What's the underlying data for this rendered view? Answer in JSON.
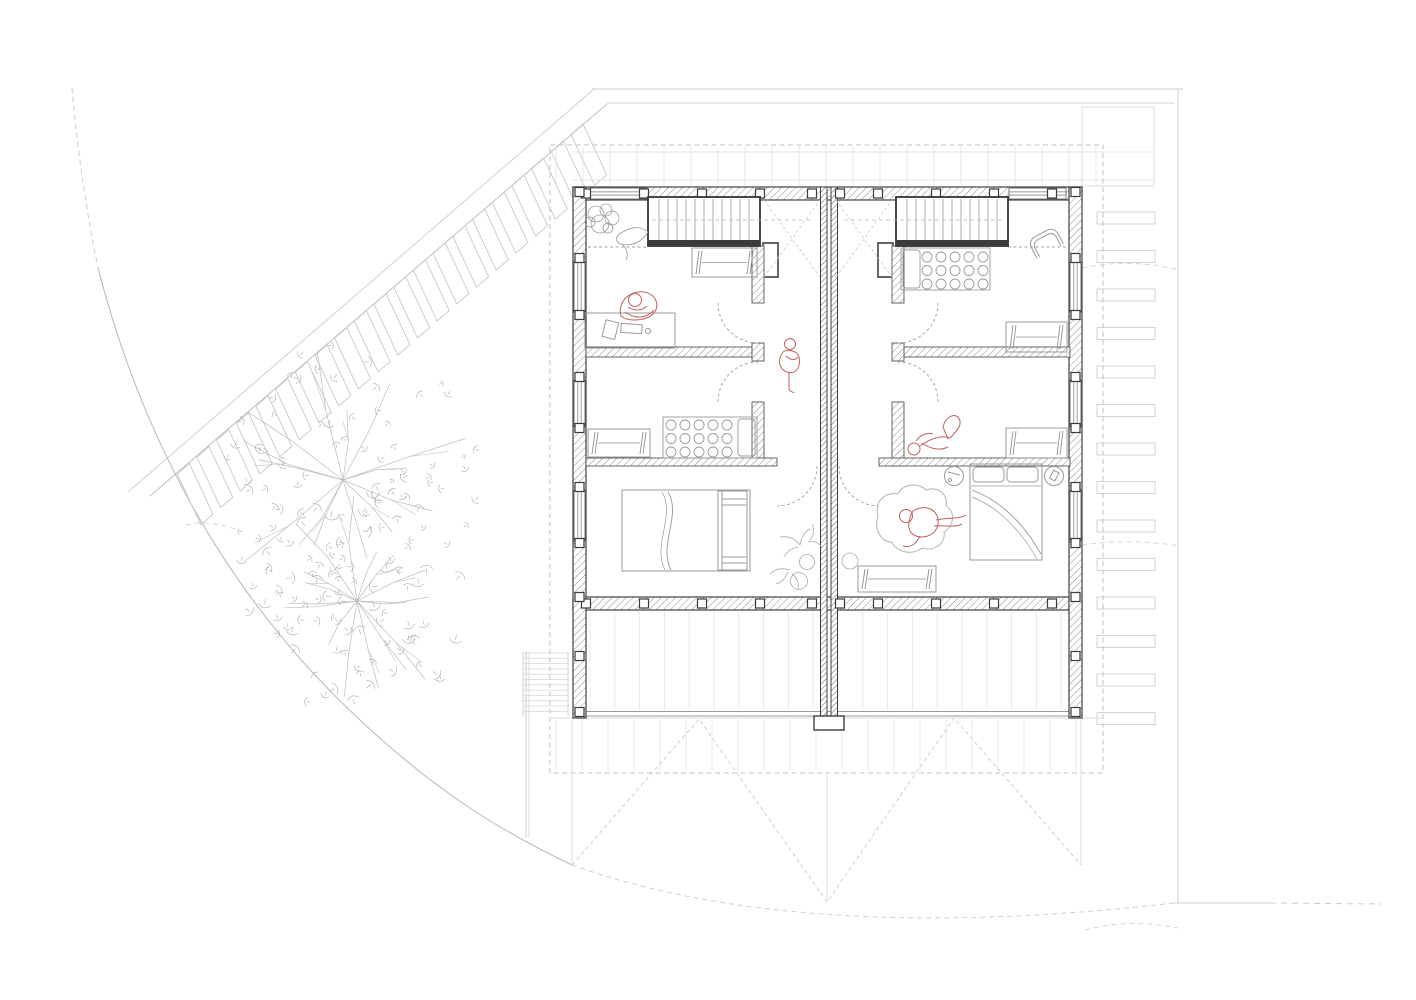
{
  "document": {
    "type": "architectural-floor-plan",
    "view": "upper-floor plan of mirrored duplex (two dwelling units) with site context",
    "visible_text": "none",
    "units": 2
  },
  "colors": {
    "wall": "#3f3f3f",
    "wall_mid": "#8f8f8f",
    "furniture": "#9a9a9a",
    "site": "#c6c6c6",
    "faint": "#e4e4e4",
    "figure_red": "#c0625c",
    "dashed": "#b9b9b9",
    "light": "#d8d8d8"
  },
  "figures": [
    {
      "id": "person-at-desk",
      "pose": "seated at desk",
      "unit": "left",
      "room": "top-left study"
    },
    {
      "id": "person-standing-hall",
      "pose": "standing on stair landing",
      "unit": "left"
    },
    {
      "id": "person-on-bed",
      "pose": "reclining on bed, knees up",
      "unit": "right",
      "room": "middle bedroom"
    },
    {
      "id": "person-in-beanbag",
      "pose": "lounging in beanbag",
      "unit": "right",
      "room": "master bedroom"
    }
  ],
  "drawing": {
    "site": {
      "parking": {
        "start": [
          583,
          124
        ],
        "roadDir": [
          -0.757,
          0.653
        ],
        "step": 26,
        "count": 21,
        "stallAlong": 16,
        "stallDeep": 56,
        "deepDir": [
          0.423,
          0.906
        ]
      },
      "steps": {
        "x": 1097,
        "w": 58,
        "h": 12,
        "y0": 212,
        "dy": 38.5,
        "count": 14
      },
      "trees": [
        {
          "cx": 343,
          "cy": 480,
          "branches": 14,
          "rMin": 60,
          "rMax": 135,
          "leaves": 72,
          "ringMin": 30,
          "ringMax": 140,
          "leafSize": 4,
          "seed": 7
        },
        {
          "cx": 357,
          "cy": 601,
          "branches": 16,
          "rMin": 50,
          "rMax": 112,
          "leaves": 84,
          "ringMin": 18,
          "ringMax": 116,
          "leafSize": 5,
          "seed": 13
        }
      ],
      "contours": [
        "M1082,268 Q1130,258 1180,270",
        "M1082,545 Q1130,538 1180,546",
        "M1085,930 Q1130,918 1178,928",
        "M186,525 Q210,519 240,531"
      ],
      "extStair": {
        "x0": 523,
        "x1": 568,
        "y0": 653,
        "dy": 5.3,
        "n": 12
      }
    },
    "building": {
      "rafterTop": {
        "x0": 556,
        "x1": 1098,
        "y0": 146,
        "y1": 186,
        "dx": 27
      },
      "rafterBottom": {
        "x0": 556,
        "x1": 1098,
        "y0": 719,
        "y1": 771,
        "dx": 26
      },
      "decking": {
        "x0": 590,
        "x1": 1066,
        "y0": 612,
        "y1": 710,
        "dx": 24.8
      },
      "posts": {
        "topXs": [
          586,
          644,
          702,
          760,
          812,
          840,
          878,
          936,
          994,
          1052
        ],
        "southXs": [
          586,
          644,
          702,
          760,
          812,
          840,
          878,
          936,
          994,
          1052
        ],
        "westYs": [
          192,
          258,
          315,
          377,
          428,
          487,
          543,
          597,
          656,
          712
        ],
        "eastYs": [
          192,
          258,
          315,
          377,
          428,
          487,
          543,
          597,
          656,
          712
        ]
      },
      "windows": {
        "north": [
          {
            "x": 590,
            "w": 57
          },
          {
            "x": 1009,
            "w": 57
          }
        ],
        "west": [
          {
            "y": 262,
            "h": 50
          },
          {
            "y": 380,
            "h": 47
          },
          {
            "y": 490,
            "h": 51
          }
        ],
        "east": [
          {
            "y": 262,
            "h": 50
          },
          {
            "y": 380,
            "h": 47
          },
          {
            "y": 490,
            "h": 51
          }
        ]
      },
      "stairs": [
        {
          "x": 648,
          "y": 197,
          "w": 112,
          "h": 49,
          "treadX0": 659,
          "treadDx": 9,
          "n": 11,
          "walk": [
            652,
            220,
            812,
            220
          ]
        },
        {
          "x": 896,
          "y": 197,
          "w": 112,
          "h": 49,
          "treadX0": 907,
          "treadDx": 9,
          "n": 11,
          "walk": [
            844,
            220,
            1004,
            220
          ]
        }
      ]
    },
    "furniture": {
      "polkaBeds": [
        {
          "x": 663,
          "y": 417,
          "w": 94,
          "h": 41,
          "pillowSide": "right",
          "cx0": 671,
          "cy0": 425,
          "cols": 5,
          "rows": 3,
          "dx": 14,
          "dy": 13.5,
          "r": 5
        },
        {
          "x": 901,
          "y": 248,
          "w": 89,
          "h": 42,
          "pillowSide": "left",
          "cx0": 927,
          "cy0": 257,
          "cols": 5,
          "rows": 3,
          "dx": 14,
          "dy": 13.5,
          "r": 5
        }
      ],
      "wardrobes": [
        {
          "x": 692,
          "y": 248,
          "w": 65,
          "h": 29
        },
        {
          "x": 588,
          "y": 429,
          "w": 62,
          "h": 28
        },
        {
          "x": 1006,
          "y": 322,
          "w": 61,
          "h": 30
        },
        {
          "x": 1006,
          "y": 428,
          "w": 61,
          "h": 30
        },
        {
          "x": 858,
          "y": 566,
          "w": 78,
          "h": 26
        }
      ]
    }
  }
}
